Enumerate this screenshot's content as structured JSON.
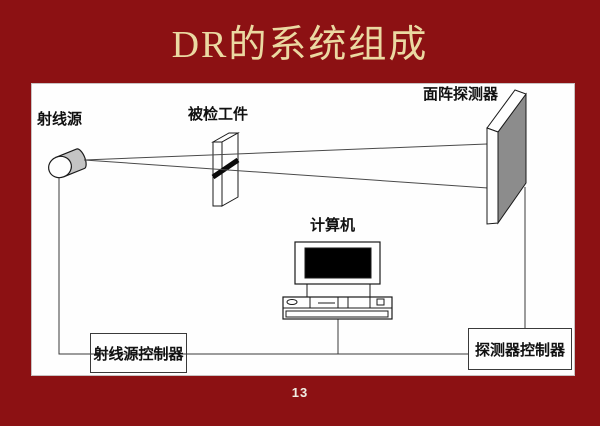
{
  "slide": {
    "title": "DR的系统组成",
    "page_number": "13"
  },
  "colors": {
    "background": "#8C1113",
    "title_text": "#EBD9A2",
    "page_number_text": "#F1EEE3",
    "panel_background": "#FEFEFE",
    "outline": "#1A1A1A",
    "detector_face_gray": "#8C8C8C",
    "cylinder_body_gray": "#C4C4C4",
    "monitor_screen_black": "#000000"
  },
  "diagram": {
    "labels": {
      "ray_source": "射线源",
      "workpiece": "被检工件",
      "detector": "面阵探测器",
      "computer": "计算机",
      "ray_source_controller": "射线源控制器",
      "detector_controller": "探测器控制器"
    }
  }
}
